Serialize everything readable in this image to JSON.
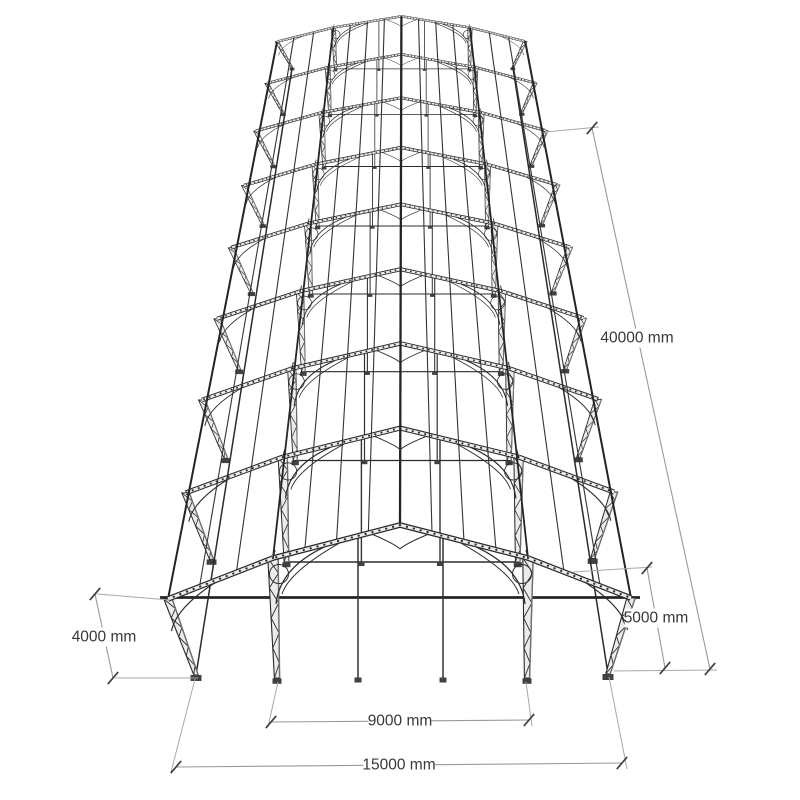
{
  "page": {
    "background": "#ffffff"
  },
  "diagram": {
    "type": "perspective-structural-steel-frame-drawing",
    "canvas": {
      "width": 800,
      "height": 800
    },
    "style": {
      "line_color": "#282828",
      "member_fill": "#ececec",
      "shade_color": "#6f6f6f",
      "plate_color": "#414141",
      "dim_line_color": "#9a9a9a",
      "ext_line_color": "#a8a8a8",
      "tick_color": "#3f3f3f",
      "text_color": "#383838",
      "font_size": 15.5,
      "background": "#ffffff"
    },
    "structure": {
      "frame_count": 9,
      "bay_spacing_mm": 5000,
      "building_length_mm": 40000,
      "overall_span_mm": 15000,
      "inner_span_mm": 9000,
      "eave_height_mm": 4000,
      "projection": {
        "vanish_x": 403,
        "vanish_y": -250,
        "shrink_x": 0.925,
        "shrink_y": 0.875,
        "element_shrink": 0.9,
        "frame0": {
          "apex": [
            400,
            525
          ],
          "haunch_left": [
            273,
            558
          ],
          "haunch_right": [
            528,
            558
          ],
          "eave_left": [
            168,
            599
          ],
          "eave_right": [
            631,
            598
          ],
          "outer_base_left": [
            196,
            675
          ],
          "outer_base_right": [
            608,
            674
          ],
          "inner_base_left": [
            277,
            678
          ],
          "inner_base_right": [
            527,
            678
          ],
          "post_left_x": 358,
          "post_right_x": 443,
          "post_top_y": 537,
          "post_base_y": 678,
          "eave_tie_y": 597.5,
          "eave_tie_x1": 160,
          "eave_tie_x2": 640
        },
        "purlins_upper": [
          0.25,
          0.5,
          0.75
        ],
        "purlins_canopy": [
          0.35,
          0.7
        ]
      }
    },
    "dimensions": [
      {
        "id": "building-length",
        "label": "40000 mm",
        "p1": [
          592,
          128
        ],
        "p2": [
          710,
          669
        ],
        "text": [
          637,
          338
        ],
        "ext": [
          [
            [
              545,
              132
            ],
            [
              599,
              127
            ]
          ],
          [
            [
              614,
              671
            ],
            [
              717,
              670
            ]
          ]
        ]
      },
      {
        "id": "bay-spacing",
        "label": "5000 mm",
        "p1": [
          647,
          568
        ],
        "p2": [
          665,
          668
        ],
        "text": [
          656,
          618
        ],
        "ext": [
          [
            [
              573,
              572
            ],
            [
              652,
              567
            ]
          ]
        ]
      },
      {
        "id": "eave-height",
        "label": "4000 mm",
        "p1": [
          95,
          594
        ],
        "p2": [
          113,
          678
        ],
        "text": [
          104,
          637
        ],
        "ext": [
          [
            [
              97,
              594
            ],
            [
              170,
              600
            ]
          ],
          [
            [
              115,
              678
            ],
            [
              198,
              678
            ]
          ]
        ]
      },
      {
        "id": "inner-span",
        "label": "9000 mm",
        "p1": [
          271,
          722
        ],
        "p2": [
          529,
          720
        ],
        "text": [
          400,
          721
        ],
        "ext": [
          [
            [
              278,
              682
            ],
            [
              268,
              727
            ]
          ],
          [
            [
              526,
              682
            ],
            [
              532,
              726
            ]
          ]
        ]
      },
      {
        "id": "overall-span",
        "label": "15000 mm",
        "p1": [
          176,
          767
        ],
        "p2": [
          622,
          763
        ],
        "text": [
          399,
          765
        ],
        "ext": [
          [
            [
              195,
              679
            ],
            [
              171,
              772
            ]
          ],
          [
            [
              609,
              677
            ],
            [
              627,
              769
            ]
          ]
        ]
      }
    ]
  }
}
